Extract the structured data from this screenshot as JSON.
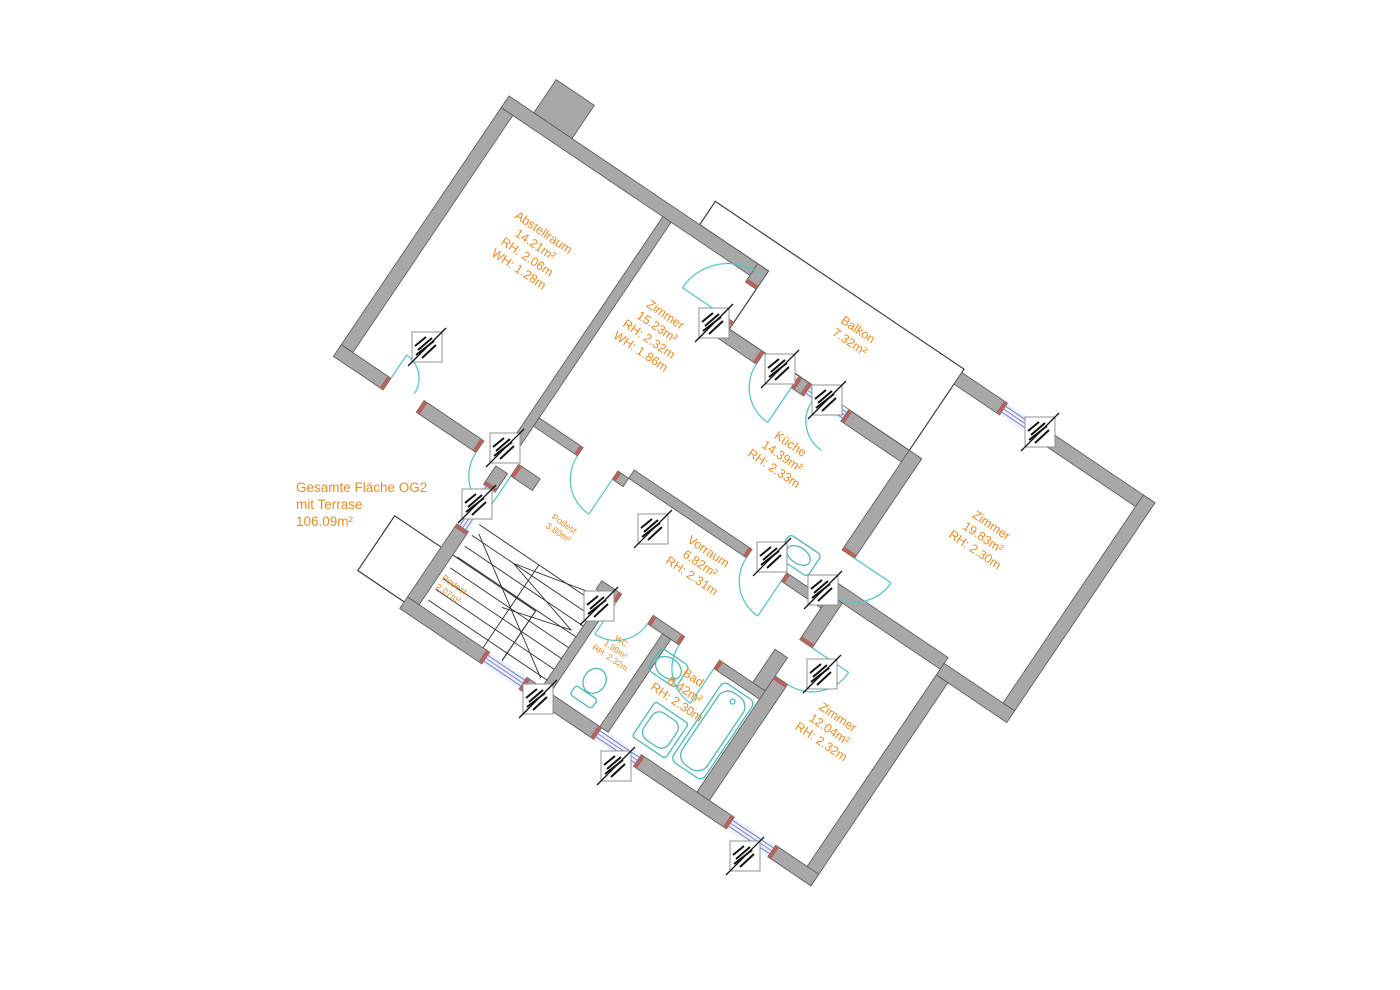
{
  "title_block": {
    "lines": [
      "Gesamte Fläche OG2",
      "mit Terrase",
      "106.09m²"
    ]
  },
  "plan": {
    "angle": 34,
    "origin": [
      509,
      96
    ],
    "colors": {
      "wall_fill": "#a8a8a8",
      "wall_stroke": "#5f5f5f",
      "label": "#ee8a1e",
      "door_arc": "#56c7c7",
      "window_line1": "#7d90cf",
      "window_line2": "#a08fd2",
      "window_fill": "#eef3fb",
      "jamb": "#b5645c",
      "thin_line": "#3d3d3d",
      "stair_line": "#2f2f2f",
      "stamp_border": "#909090",
      "stamp_ink": "#141414",
      "fixture": "#49b9b9"
    },
    "rooms": [
      {
        "name": "abstellraum",
        "lines": [
          "Abstellraum",
          "14.21m²",
          "RH: 2.06m",
          "WH: 1.28m"
        ],
        "x": 105,
        "y": 120,
        "fs": 12.5
      },
      {
        "name": "zimmer-1",
        "lines": [
          "Zimmer",
          "15.23m²",
          "RH: 2.32m",
          "WH: 1.86m"
        ],
        "x": 252,
        "y": 120,
        "fs": 12.5
      },
      {
        "name": "balkon",
        "lines": [
          "Balkon",
          "7.32m²"
        ],
        "x": 420,
        "y": 10,
        "fs": 12.5
      },
      {
        "name": "kueche",
        "lines": [
          "Küche",
          "14.39m²",
          "RH: 2.33m"
        ],
        "x": 428,
        "y": 150,
        "fs": 12.5
      },
      {
        "name": "zimmer-2",
        "lines": [
          "Zimmer",
          "19.83m²",
          "RH: 2.30m"
        ],
        "x": 640,
        "y": 105,
        "fs": 12.5
      },
      {
        "name": "vorraum",
        "lines": [
          "Vorraum",
          "6.82m²",
          "RH: 2.31m"
        ],
        "x": 420,
        "y": 285,
        "fs": 12.5
      },
      {
        "name": "podest-og",
        "lines": [
          "Podest",
          "3.80m²"
        ],
        "x": 285,
        "y": 332,
        "fs": 9
      },
      {
        "name": "podest-zg",
        "lines": [
          "Podest",
          "2.07m²"
        ],
        "x": 228,
        "y": 444,
        "fs": 9
      },
      {
        "name": "wc",
        "lines": [
          "WC",
          "1.96m²",
          "RH: 2.32m"
        ],
        "x": 398,
        "y": 402,
        "fs": 8.5
      },
      {
        "name": "bad",
        "lines": [
          "Bad",
          "8.42m²",
          "RH: 2.30m"
        ],
        "x": 478,
        "y": 398,
        "fs": 12.5
      },
      {
        "name": "zimmer-3",
        "lines": [
          "Zimmer",
          "12.04m²",
          "RH: 2.32m"
        ],
        "x": 620,
        "y": 350,
        "fs": 12.5
      }
    ],
    "walls": [
      [
        0,
        0,
        313,
        14
      ],
      [
        30,
        -40,
        46,
        40
      ],
      [
        0,
        14,
        14,
        286
      ],
      [
        0,
        300,
        60,
        14
      ],
      [
        100,
        300,
        72,
        14
      ],
      [
        214,
        300,
        26,
        14
      ],
      [
        195,
        14,
        10,
        286
      ],
      [
        205,
        250,
        53,
        10
      ],
      [
        300,
        250,
        13,
        10
      ],
      [
        300,
        0,
        13,
        22
      ],
      [
        300,
        62,
        13,
        8
      ],
      [
        300,
        70,
        55,
        14
      ],
      [
        397,
        70,
        15,
        14
      ],
      [
        457,
        70,
        88,
        14
      ],
      [
        313,
        240,
        142,
        10
      ],
      [
        497,
        240,
        33,
        10
      ],
      [
        530,
        -24,
        55,
        14
      ],
      [
        640,
        -24,
        123,
        14
      ],
      [
        749,
        -24,
        14,
        251
      ],
      [
        530,
        70,
        15,
        120
      ],
      [
        530,
        234,
        15,
        16
      ],
      [
        545,
        220,
        133,
        14
      ],
      [
        678,
        227,
        85,
        14
      ],
      [
        678,
        241,
        14,
        245
      ],
      [
        196,
        472,
        99,
        14
      ],
      [
        340,
        472,
        90,
        14
      ],
      [
        478,
        472,
        112,
        14
      ],
      [
        640,
        472,
        52,
        14
      ],
      [
        196,
        314,
        14,
        22
      ],
      [
        196,
        384,
        14,
        88
      ],
      [
        358,
        360,
        10,
        112
      ],
      [
        348,
        350,
        24,
        10
      ],
      [
        410,
        350,
        38,
        10
      ],
      [
        490,
        350,
        70,
        10
      ],
      [
        428,
        360,
        10,
        112
      ],
      [
        545,
        234,
        15,
        54
      ],
      [
        545,
        332,
        15,
        140
      ],
      [
        530,
        310,
        15,
        40
      ]
    ],
    "jambs": [
      [
        168,
        300,
        4,
        14
      ],
      [
        214,
        300,
        4,
        14
      ],
      [
        56,
        300,
        4,
        14
      ],
      [
        100,
        300,
        4,
        14
      ],
      [
        196,
        332,
        14,
        4
      ],
      [
        196,
        384,
        14,
        4
      ],
      [
        291,
        472,
        4,
        14
      ],
      [
        340,
        472,
        4,
        14
      ],
      [
        426,
        472,
        4,
        14
      ],
      [
        478,
        472,
        4,
        14
      ],
      [
        586,
        472,
        4,
        14
      ],
      [
        640,
        472,
        4,
        14
      ],
      [
        581,
        -24,
        4,
        14
      ],
      [
        640,
        -24,
        4,
        14
      ],
      [
        351,
        70,
        4,
        14
      ],
      [
        397,
        70,
        4,
        14
      ],
      [
        408,
        70,
        4,
        14
      ],
      [
        457,
        70,
        4,
        14
      ],
      [
        300,
        18,
        13,
        4
      ],
      [
        300,
        62,
        13,
        4
      ],
      [
        254,
        250,
        4,
        10
      ],
      [
        300,
        250,
        4,
        10
      ],
      [
        451,
        240,
        4,
        10
      ],
      [
        497,
        240,
        4,
        10
      ],
      [
        530,
        186,
        15,
        4
      ],
      [
        530,
        234,
        15,
        4
      ],
      [
        368,
        350,
        4,
        10
      ],
      [
        410,
        350,
        4,
        10
      ],
      [
        444,
        350,
        4,
        10
      ],
      [
        490,
        350,
        4,
        10
      ],
      [
        545,
        284,
        15,
        4
      ],
      [
        545,
        332,
        15,
        4
      ]
    ],
    "windows": [
      {
        "name": "stair-window",
        "rect": [
          196,
          336,
          14,
          48
        ],
        "dir": "v"
      },
      {
        "name": "sw-window",
        "rect": [
          295,
          472,
          45,
          14
        ],
        "dir": "h"
      },
      {
        "name": "bad-window",
        "rect": [
          430,
          472,
          48,
          14
        ],
        "dir": "h"
      },
      {
        "name": "zimmer3-window",
        "rect": [
          590,
          472,
          50,
          14
        ],
        "dir": "h"
      },
      {
        "name": "zimmer2-window",
        "rect": [
          585,
          -24,
          55,
          14
        ],
        "dir": "h"
      },
      {
        "name": "kueche-balcony-window",
        "rect": [
          412,
          70,
          45,
          14
        ],
        "dir": "h"
      }
    ],
    "doors": [
      {
        "name": "entrance-door",
        "d": "M172 314 A42 42 0 0 0 214 356",
        "leaf": [
          214,
          314,
          214,
          356
        ]
      },
      {
        "name": "zimmer1-balcony-door",
        "d": "M306 7 A55 55 0 0 0 251 62",
        "leaf": [
          306,
          62,
          251,
          62
        ]
      },
      {
        "name": "kueche-balcony-door",
        "d": "M355 84 A42 42 0 0 0 397 126",
        "leaf": [
          397,
          84,
          397,
          126
        ]
      },
      {
        "name": "abstellraum-opening",
        "d": "M88 300 A28 28 0 0 0 60 272",
        "leaf": [
          60,
          300,
          60,
          272
        ]
      },
      {
        "name": "zimmer1-door",
        "d": "M258 260 A42 42 0 0 0 300 302",
        "leaf": [
          300,
          260,
          300,
          302
        ]
      },
      {
        "name": "kueche-door",
        "d": "M455 250 A42 42 0 0 0 497 292",
        "leaf": [
          497,
          250,
          497,
          292
        ]
      },
      {
        "name": "zimmer2-door",
        "d": "M545 234 A44 44 0 0 0 589 190",
        "leaf": [
          545,
          190,
          589,
          190
        ]
      },
      {
        "name": "zimmer3-door",
        "d": "M560 332 A44 44 0 0 0 604 288",
        "leaf": [
          560,
          288,
          604,
          288
        ]
      },
      {
        "name": "wc-door",
        "d": "M410 360 A38 38 0 0 1 372 398",
        "leaf": [
          372,
          360,
          372,
          398
        ]
      },
      {
        "name": "bad-door",
        "d": "M448 360 A42 42 0 0 0 490 402",
        "leaf": [
          490,
          360,
          490,
          402
        ]
      },
      {
        "name": "kueche-window-arc",
        "d": "M422 84 A35 35 0 0 0 457 119",
        "leaf": null
      }
    ],
    "outlines": [
      {
        "name": "balcony-outline",
        "points": "230,-28 530,-28 530,70 313,70 313,0 230,0"
      },
      {
        "name": "podest-zg-outline",
        "points": "140,412 310,412 310,478 140,478"
      }
    ],
    "stairs": {
      "treads": {
        "x1": 215,
        "x2": 358,
        "ys": [
          372,
          385,
          398,
          411,
          424,
          437,
          450,
          463
        ]
      },
      "divider": [
        287,
        372,
        287,
        472
      ],
      "break_line": [
        220,
        380,
        352,
        465
      ],
      "zigzag": "350,365 265,385 350,408 280,428"
    },
    "fixtures": [
      {
        "type": "tub",
        "name": "bathtub",
        "rect": [
          505,
          365,
          38,
          95
        ]
      },
      {
        "type": "washer",
        "name": "shower-washer",
        "rect": [
          460,
          420,
          40,
          42
        ]
      },
      {
        "type": "sink",
        "name": "bad-sink",
        "cx": 452,
        "cy": 385,
        "rx": 14,
        "ry": 10
      },
      {
        "type": "toilet",
        "name": "wc-toilet",
        "cx": 398,
        "cy": 437
      },
      {
        "type": "kitchen-sink",
        "name": "kitchen-sink",
        "rect": [
          478,
          206,
          38,
          26
        ]
      }
    ],
    "stamps": [
      {
        "name": "abstellraum-window-stamp",
        "x": 427,
        "y": 347
      },
      {
        "name": "zimmer1-balcony-door-stamp",
        "x": 714,
        "y": 323
      },
      {
        "name": "kueche-balcony-door-stamp",
        "x": 780,
        "y": 369
      },
      {
        "name": "kueche-balcony-window-stamp",
        "x": 827,
        "y": 400
      },
      {
        "name": "zimmer2-window-stamp",
        "x": 1040,
        "y": 432
      },
      {
        "name": "stair-window-stamp",
        "x": 477,
        "y": 504
      },
      {
        "name": "entrance-door-stamp",
        "x": 505,
        "y": 448
      },
      {
        "name": "zimmer1-door-stamp",
        "x": 653,
        "y": 529
      },
      {
        "name": "kueche-door-stamp",
        "x": 772,
        "y": 557
      },
      {
        "name": "zimmer2-door-stamp",
        "x": 823,
        "y": 590
      },
      {
        "name": "wc-door-stamp",
        "x": 599,
        "y": 606
      },
      {
        "name": "zimmer3-door-stamp",
        "x": 822,
        "y": 674
      },
      {
        "name": "sw-window-stamp",
        "x": 538,
        "y": 699
      },
      {
        "name": "bad-window-stamp",
        "x": 616,
        "y": 766
      },
      {
        "name": "zimmer3-window-stamp",
        "x": 745,
        "y": 856
      }
    ]
  }
}
